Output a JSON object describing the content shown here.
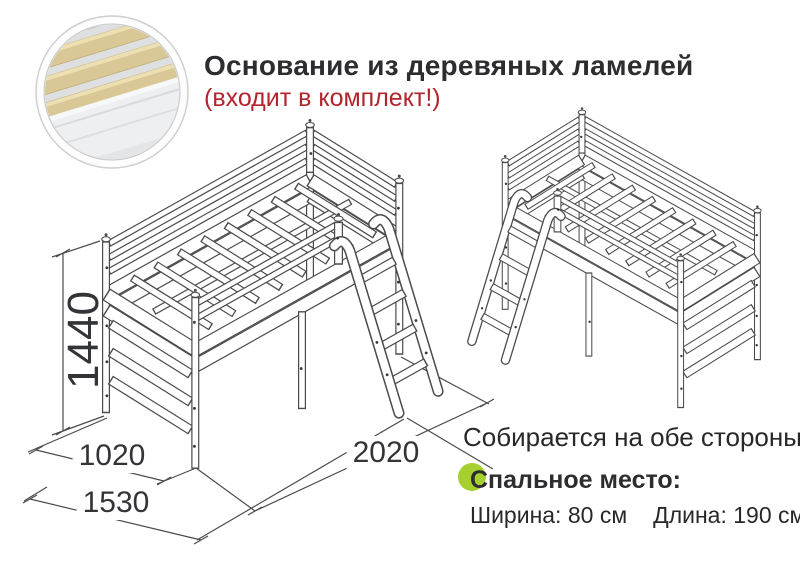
{
  "heading": {
    "title": "Основание из деревяных ламелей",
    "note": "(входит в комплект!)"
  },
  "inset": {
    "label": "wood-slats-closeup"
  },
  "dimensions": {
    "height_mm": "1440",
    "depth_mm": "1020",
    "depth_with_ladder_mm": "1530",
    "length_mm": "2020"
  },
  "notes": {
    "both_sides": "Собирается на обе стороны"
  },
  "sleeping_area": {
    "title": "Спальное место:",
    "width": "Ширина: 80 см",
    "length": "Длина: 190 см"
  },
  "colors": {
    "note_red": "#b2252c",
    "marker_green": "#a6d02f",
    "line_gray": "#4b4b4d",
    "slat_wood": "#d9c795",
    "text_dark": "#2d2d2f"
  }
}
